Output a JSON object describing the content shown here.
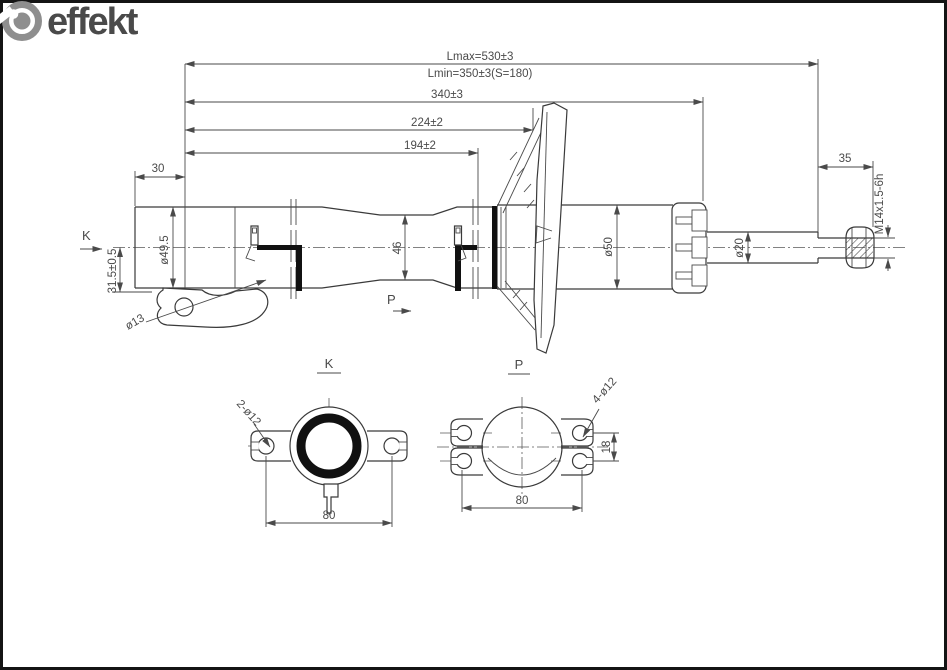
{
  "logo": {
    "brand": "effekt"
  },
  "colors": {
    "line": "#4a4a4a",
    "edges": "#3a3a3a",
    "thick_parts": "#111111",
    "logo_gray": "#8e8e8e"
  },
  "main_view": {
    "view_markers": {
      "k": "K",
      "p": "P"
    },
    "dims": {
      "lmax": "Lmax=530±3",
      "lmin": "Lmin=350±3(S=180)",
      "d340": "340±3",
      "d224": "224±2",
      "d194": "194±2",
      "d30": "30",
      "d35": "35",
      "dia49_5": "ø49.5",
      "h31_5": "31.5±0.5",
      "dia13": "ø13",
      "d46": "46",
      "dia50": "ø50",
      "dia20": "ø20",
      "thread": "M14x1.5-6h"
    }
  },
  "section_k": {
    "title": "K",
    "holes": "2-ø12",
    "width": "80"
  },
  "section_p": {
    "title": "P",
    "holes": "4-ø12",
    "spacing": "18",
    "width": "80"
  }
}
